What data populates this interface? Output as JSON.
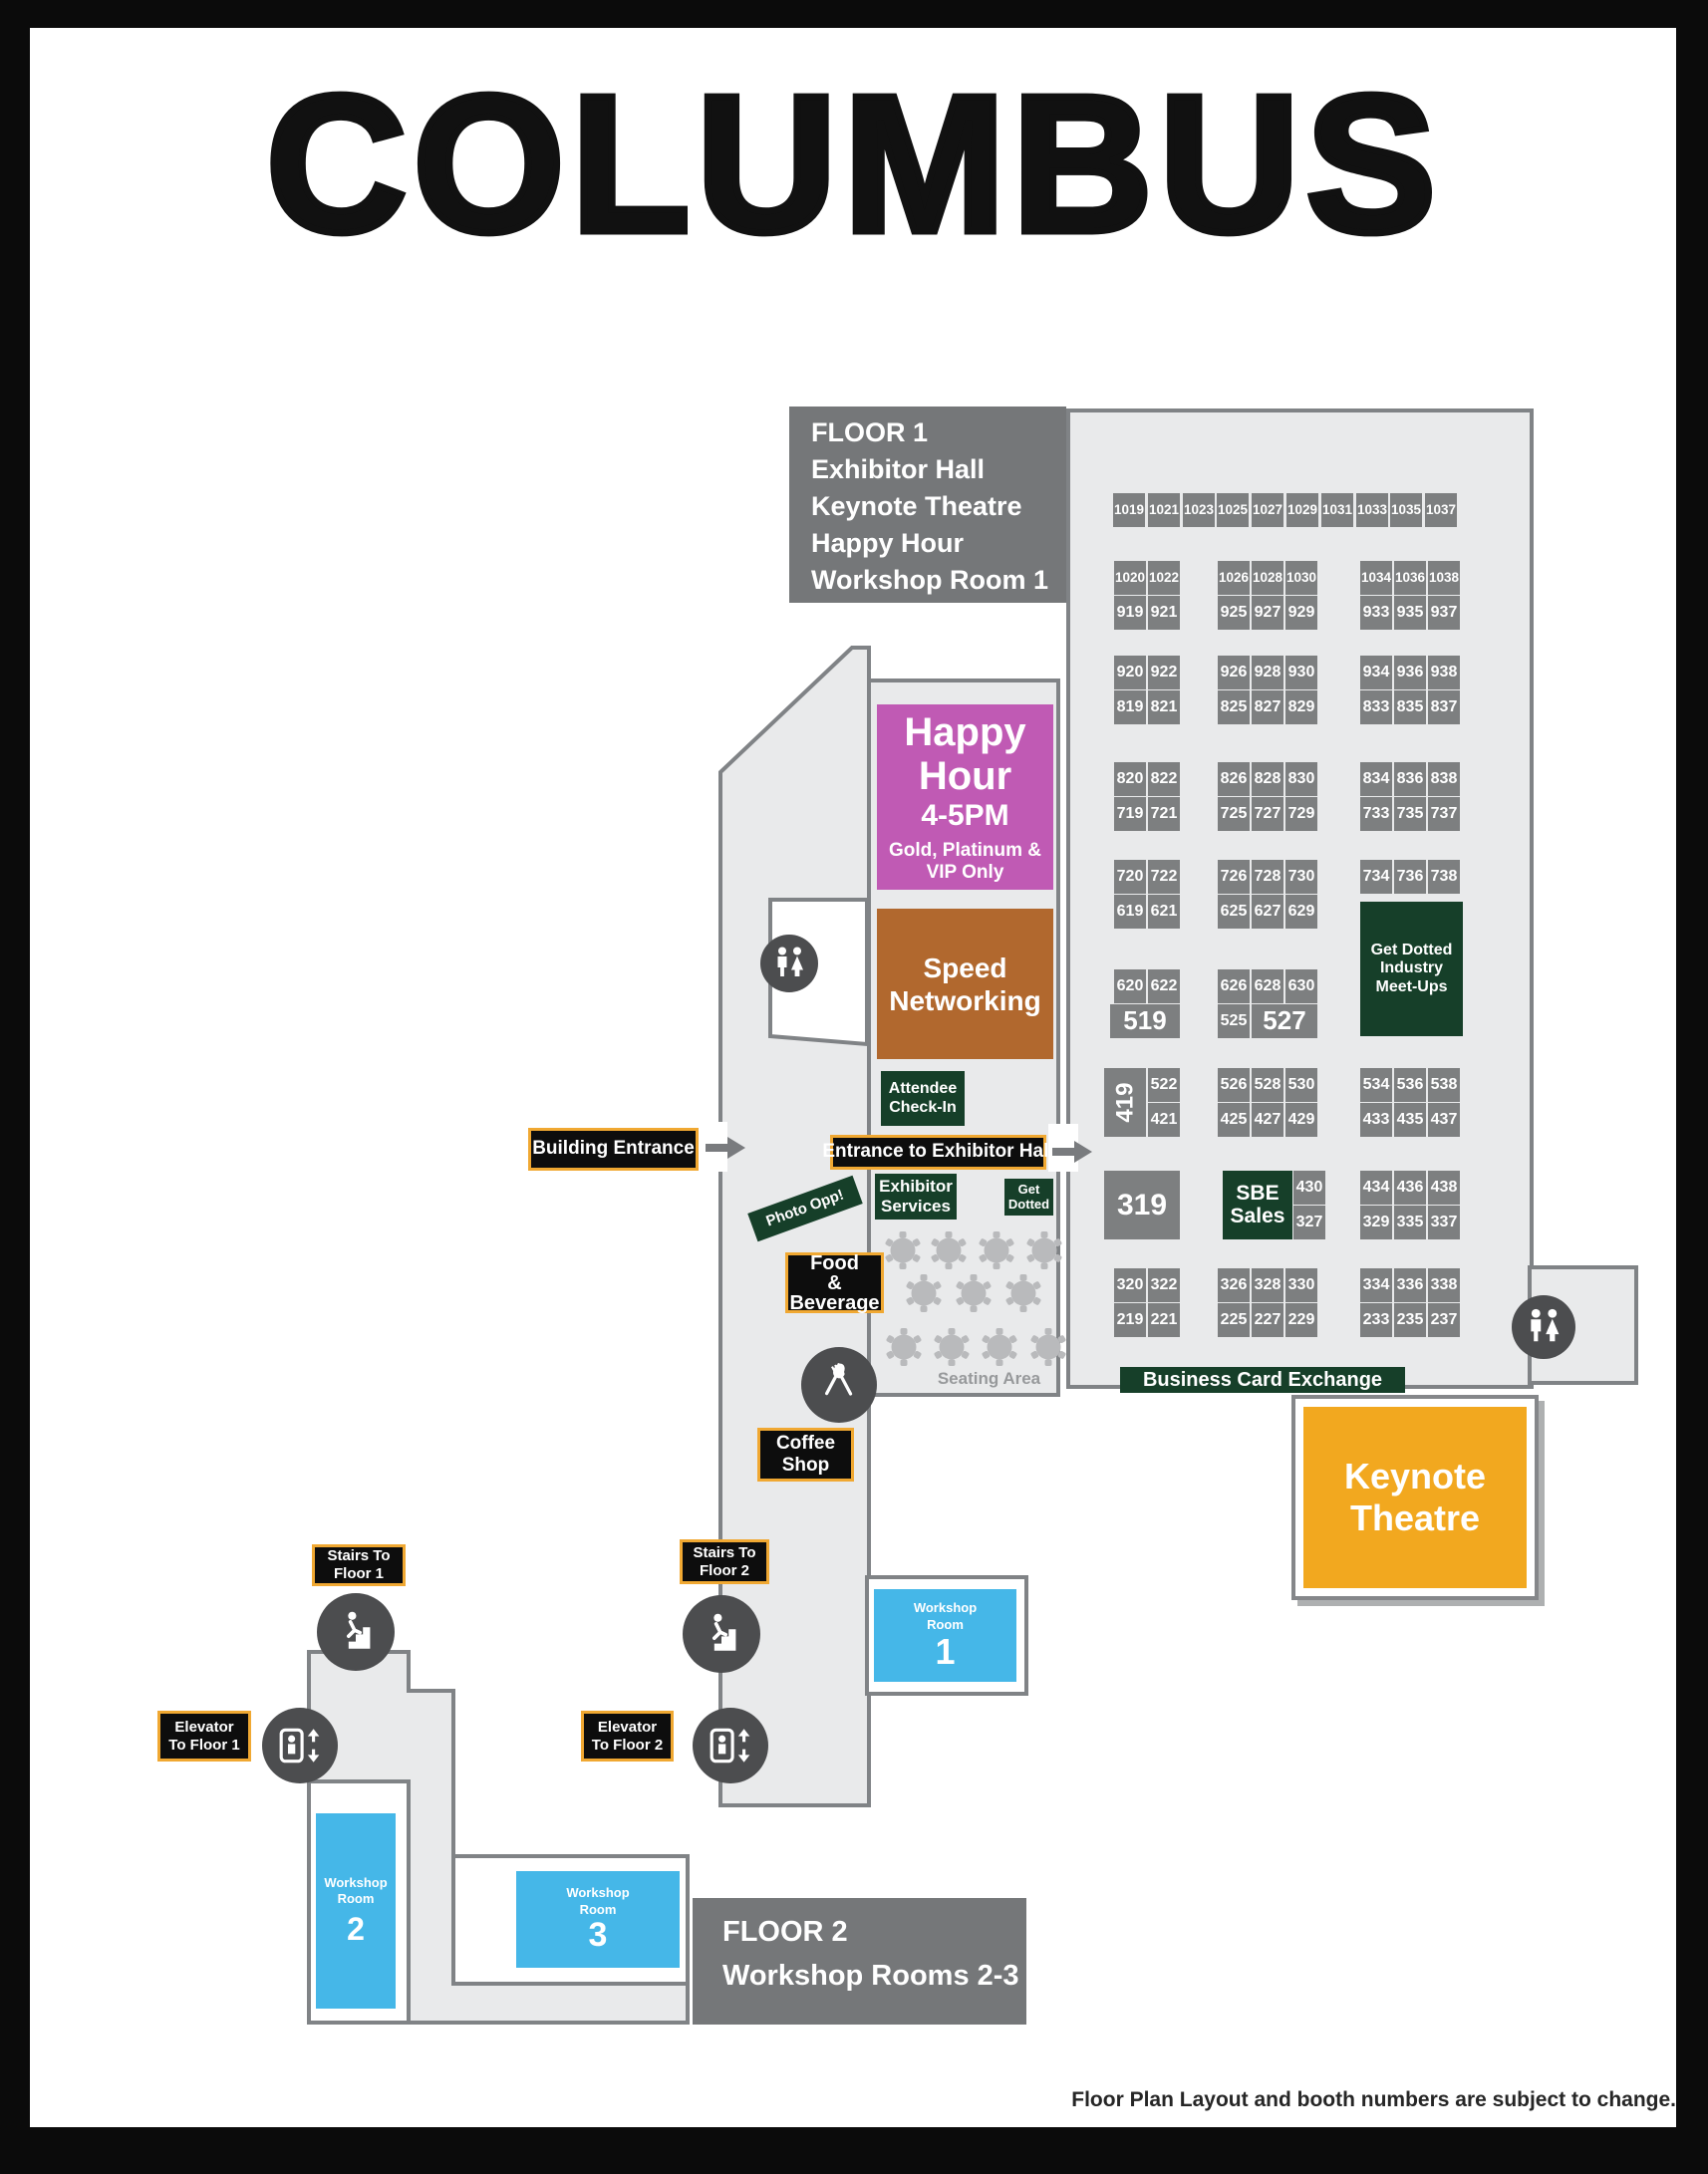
{
  "title": "COLUMBUS",
  "footer": "Floor Plan Layout and booth numbers are subject to change.",
  "colors": {
    "booth_gray": "#7d7f80",
    "legend_gray": "#757779",
    "floor": "#e9eaeb",
    "wall": "#808386",
    "dark_green": "#163f29",
    "magenta": "#c05ab4",
    "brown": "#b1682e",
    "keynote_yellow": "#f2a81f",
    "workshop_blue": "#45b7e8",
    "sign_black": "#0d0d0d",
    "sign_gold_border": "#f0a832",
    "icon_circle_gray": "#4c4d4f"
  },
  "floor1_legend": {
    "line1": "FLOOR 1",
    "line2": "Exhibitor Hall",
    "line3": "Keynote Theatre",
    "line4": "Happy Hour",
    "line5": "Workshop Room 1"
  },
  "floor2_legend": {
    "line1": "FLOOR 2",
    "line2": "Workshop Rooms 2-3"
  },
  "areas": {
    "happy_hour": {
      "name": "Happy Hour",
      "time": "4-5PM",
      "restriction": "Gold, Platinum & VIP Only"
    },
    "speed_networking": {
      "name": "Speed Networking"
    },
    "attendee_checkin": {
      "name": "Attendee Check-In"
    },
    "exhibitor_services": {
      "name": "Exhibitor Services"
    },
    "get_dotted": {
      "name": "Get Dotted"
    },
    "get_dotted_meetups": {
      "name": "Get Dotted Industry Meet-Ups"
    },
    "business_card_exchange": {
      "name": "Business Card Exchange"
    },
    "keynote_theatre": {
      "name": "Keynote Theatre"
    },
    "seating_area": {
      "name": "Seating Area"
    },
    "coffee_shop": {
      "name": "Coffee Shop"
    },
    "food_beverage": {
      "l1": "Food",
      "l2": "&",
      "l3": "Beverage"
    },
    "photo_opp": {
      "name": "Photo Opp!"
    }
  },
  "signs": {
    "building_entrance": "Building Entrance",
    "entrance_exhibitor_hall": "Entrance to Exhibitor Hall",
    "stairs_floor1": "Stairs To Floor 1",
    "stairs_floor2": "Stairs To Floor 2",
    "elevator_floor1": "Elevator To Floor 1",
    "elevator_floor2": "Elevator To Floor 2"
  },
  "workshop_rooms": {
    "label": "Workshop Room",
    "room1": "1",
    "room2": "2",
    "room3": "3"
  },
  "booths": {
    "top_row": [
      "1019",
      "1021",
      "1023",
      "1025",
      "1027",
      "1029",
      "1031",
      "1033",
      "1035",
      "1037"
    ],
    "blocks": [
      {
        "rows": [
          {
            "left": [
              "1020",
              "1022"
            ],
            "mid": [
              "1026",
              "1028",
              "1030"
            ],
            "right": [
              "1034",
              "1036",
              "1038"
            ]
          },
          {
            "left": [
              "919",
              "921"
            ],
            "mid": [
              "925",
              "927",
              "929"
            ],
            "right": [
              "933",
              "935",
              "937"
            ]
          }
        ]
      },
      {
        "rows": [
          {
            "left": [
              "920",
              "922"
            ],
            "mid": [
              "926",
              "928",
              "930"
            ],
            "right": [
              "934",
              "936",
              "938"
            ]
          },
          {
            "left": [
              "819",
              "821"
            ],
            "mid": [
              "825",
              "827",
              "829"
            ],
            "right": [
              "833",
              "835",
              "837"
            ]
          }
        ]
      },
      {
        "rows": [
          {
            "left": [
              "820",
              "822"
            ],
            "mid": [
              "826",
              "828",
              "830"
            ],
            "right": [
              "834",
              "836",
              "838"
            ]
          },
          {
            "left": [
              "719",
              "721"
            ],
            "mid": [
              "725",
              "727",
              "729"
            ],
            "right": [
              "733",
              "735",
              "737"
            ]
          }
        ]
      },
      {
        "rows": [
          {
            "left": [
              "720",
              "722"
            ],
            "mid": [
              "726",
              "728",
              "730"
            ],
            "right": [
              "734",
              "736",
              "738"
            ]
          },
          {
            "left": [
              "619",
              "621"
            ],
            "mid": [
              "625",
              "627",
              "629"
            ],
            "right": []
          }
        ]
      },
      {
        "rows": [
          {
            "left": [
              "620",
              "622"
            ],
            "mid": [
              "626",
              "628",
              "630"
            ],
            "right": []
          },
          {
            "left": [
              {
                "t": "519",
                "wide": true
              }
            ],
            "mid": [
              "525",
              {
                "t": "527",
                "wide": true
              }
            ],
            "right": []
          }
        ]
      },
      {
        "rows": [
          {
            "left": [
              {
                "t": "419",
                "rotated": true
              },
              "522"
            ],
            "mid": [
              "526",
              "528",
              "530"
            ],
            "right": [
              "534",
              "536",
              "538"
            ]
          },
          {
            "left": [
              null,
              "421"
            ],
            "mid": [
              "425",
              "427",
              "429"
            ],
            "right": [
              "433",
              "435",
              "437"
            ]
          }
        ]
      },
      {
        "rows": [
          {
            "left": [
              {
                "t": "319",
                "large": true
              }
            ],
            "mid": [
              {
                "t": "SBE Sales",
                "green": true
              },
              "430"
            ],
            "right": [
              "434",
              "436",
              "438"
            ]
          },
          {
            "left": [],
            "mid": [
              null,
              "327"
            ],
            "right": [
              "329",
              "335",
              "337"
            ]
          }
        ]
      },
      {
        "rows": [
          {
            "left": [
              "320",
              "322"
            ],
            "mid": [
              "326",
              "328",
              "330"
            ],
            "right": [
              "334",
              "336",
              "338"
            ]
          },
          {
            "left": [
              "219",
              "221"
            ],
            "mid": [
              "225",
              "227",
              "229"
            ],
            "right": [
              "233",
              "235",
              "237"
            ]
          }
        ]
      }
    ]
  }
}
